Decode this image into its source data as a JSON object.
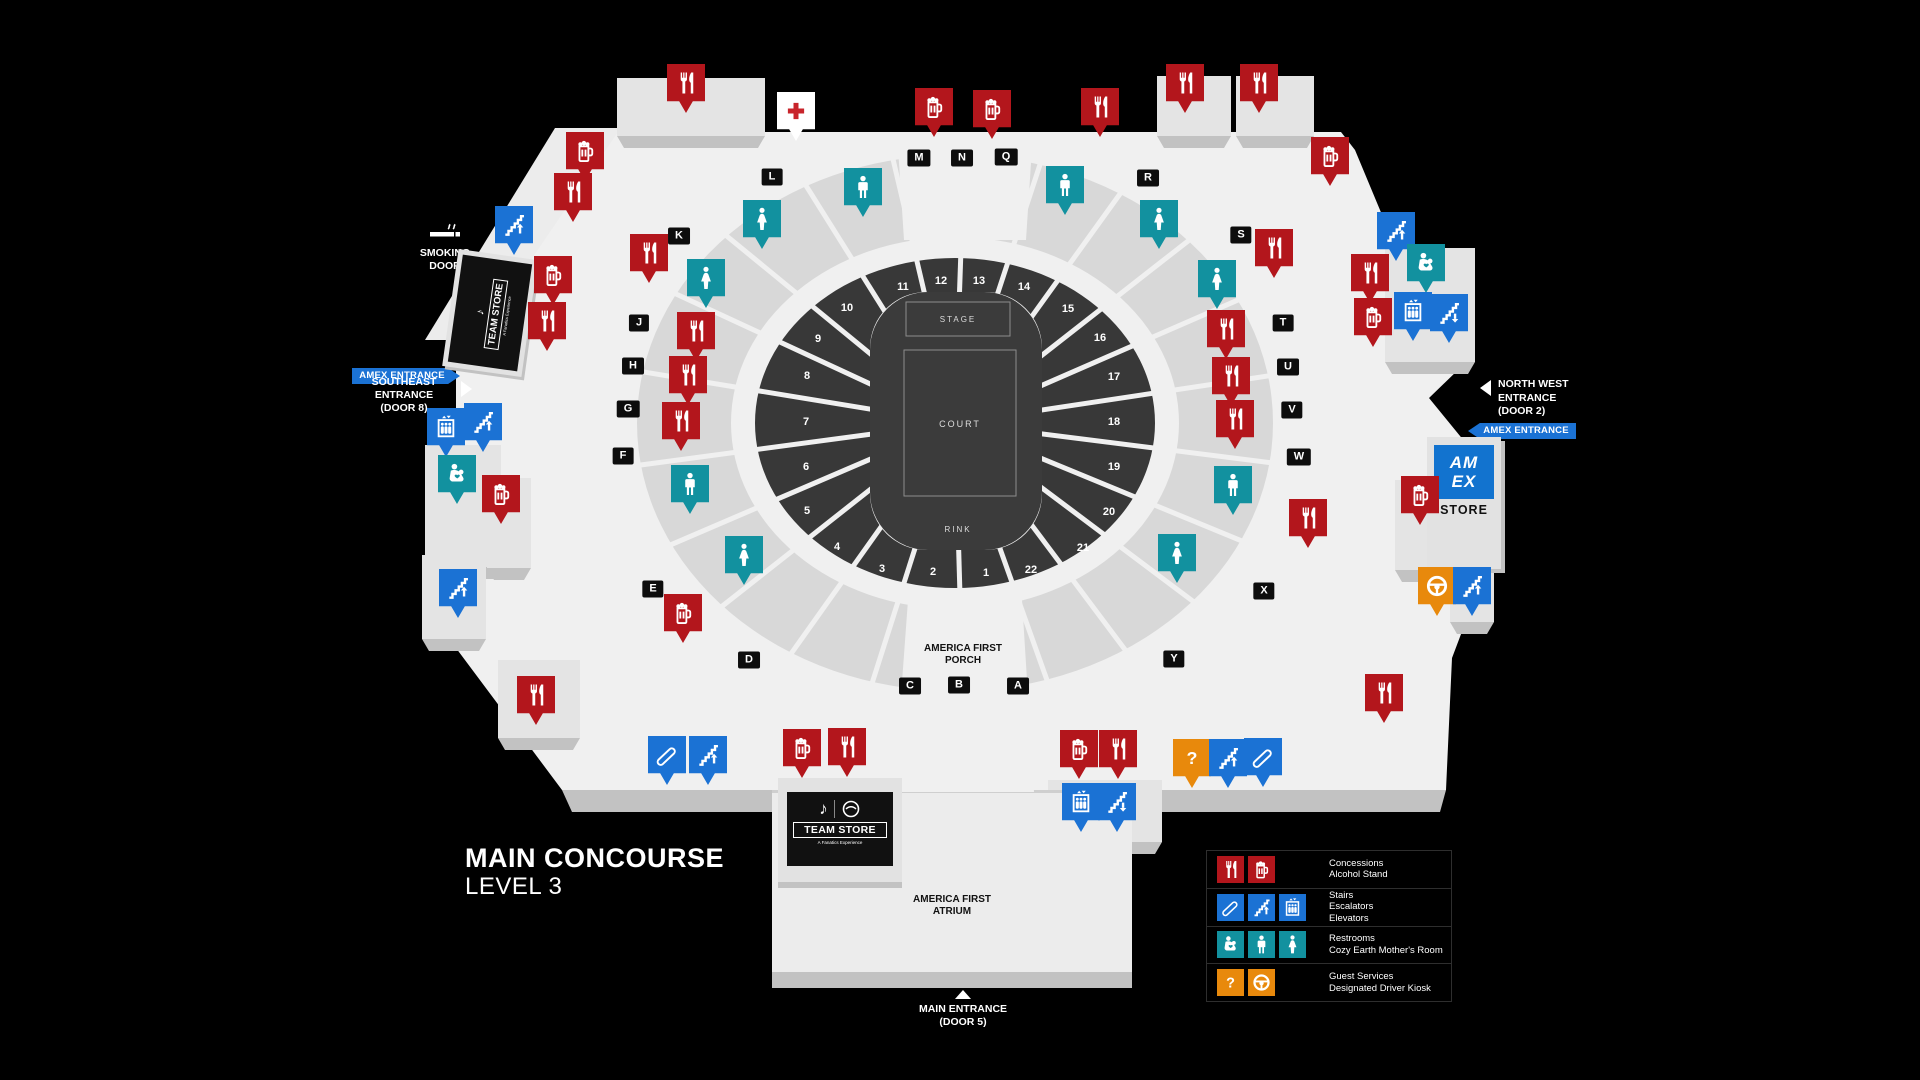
{
  "colors": {
    "red": "#b3161c",
    "blue": "#1b72d4",
    "teal": "#12919f",
    "orange": "#e8890c"
  },
  "title": {
    "line1": "MAIN CONCOURSE",
    "line2": "LEVEL 3"
  },
  "arena": {
    "stage": "STAGE",
    "court": "COURT",
    "rink": "RINK"
  },
  "porch": {
    "line1": "AMERICA FIRST",
    "line2": "PORCH"
  },
  "atrium": {
    "line1": "AMERICA FIRST",
    "line2": "ATRIUM"
  },
  "entrances": {
    "main": {
      "line1": "MAIN ENTRANCE",
      "line2": "(DOOR 5)"
    },
    "southeast": {
      "line1": "SOUTHEAST",
      "line2": "ENTRANCE",
      "line3": "(DOOR 8)"
    },
    "northwest": {
      "line1": "NORTH WEST",
      "line2": "ENTRANCE",
      "line3": "(DOOR 2)"
    },
    "amex_label": "AMEX ENTRANCE",
    "smoking": {
      "line1": "SMOKING",
      "line2": "DOOR"
    }
  },
  "stores": {
    "team_store": {
      "name": "TEAM STORE",
      "sub": "A Fanatics Experience",
      "note_icon": "♪"
    },
    "amex": {
      "logo_line1": "AM",
      "logo_line2": "EX",
      "label": "STORE"
    }
  },
  "legend": {
    "rows": [
      {
        "color": "red",
        "icons": [
          "fork",
          "beer"
        ],
        "lines": [
          "Concessions",
          "Alcohol Stand"
        ]
      },
      {
        "color": "blue",
        "icons": [
          "escalator",
          "stairs-up",
          "elevator"
        ],
        "lines": [
          "Stairs",
          "Escalators",
          "Elevators"
        ]
      },
      {
        "color": "teal",
        "icons": [
          "mother",
          "man",
          "woman"
        ],
        "lines": [
          "Restrooms",
          "Cozy Earth Mother's Room"
        ]
      },
      {
        "color": "orange",
        "icons": [
          "question",
          "driver"
        ],
        "lines": [
          "Guest Services",
          "Designated Driver Kiosk"
        ]
      }
    ]
  },
  "sections": [
    {
      "n": "1",
      "x": 986,
      "y": 572
    },
    {
      "n": "2",
      "x": 933,
      "y": 571
    },
    {
      "n": "3",
      "x": 882,
      "y": 568
    },
    {
      "n": "4",
      "x": 837,
      "y": 546
    },
    {
      "n": "5",
      "x": 807,
      "y": 510
    },
    {
      "n": "6",
      "x": 806,
      "y": 466
    },
    {
      "n": "7",
      "x": 806,
      "y": 421
    },
    {
      "n": "8",
      "x": 807,
      "y": 375
    },
    {
      "n": "9",
      "x": 818,
      "y": 338
    },
    {
      "n": "10",
      "x": 847,
      "y": 307
    },
    {
      "n": "11",
      "x": 903,
      "y": 286
    },
    {
      "n": "12",
      "x": 941,
      "y": 280
    },
    {
      "n": "13",
      "x": 979,
      "y": 280
    },
    {
      "n": "14",
      "x": 1024,
      "y": 286
    },
    {
      "n": "15",
      "x": 1068,
      "y": 308
    },
    {
      "n": "16",
      "x": 1100,
      "y": 337
    },
    {
      "n": "17",
      "x": 1114,
      "y": 376
    },
    {
      "n": "18",
      "x": 1114,
      "y": 421
    },
    {
      "n": "19",
      "x": 1114,
      "y": 466
    },
    {
      "n": "20",
      "x": 1109,
      "y": 511
    },
    {
      "n": "21",
      "x": 1083,
      "y": 547
    },
    {
      "n": "22",
      "x": 1031,
      "y": 569
    }
  ],
  "letters": [
    {
      "l": "A",
      "x": 1018,
      "y": 686
    },
    {
      "l": "B",
      "x": 959,
      "y": 685
    },
    {
      "l": "C",
      "x": 910,
      "y": 686
    },
    {
      "l": "D",
      "x": 749,
      "y": 660
    },
    {
      "l": "E",
      "x": 653,
      "y": 589
    },
    {
      "l": "F",
      "x": 623,
      "y": 456
    },
    {
      "l": "G",
      "x": 628,
      "y": 409
    },
    {
      "l": "H",
      "x": 633,
      "y": 366
    },
    {
      "l": "J",
      "x": 639,
      "y": 323
    },
    {
      "l": "K",
      "x": 679,
      "y": 236
    },
    {
      "l": "L",
      "x": 772,
      "y": 177
    },
    {
      "l": "M",
      "x": 919,
      "y": 158
    },
    {
      "l": "N",
      "x": 962,
      "y": 158
    },
    {
      "l": "Q",
      "x": 1006,
      "y": 157
    },
    {
      "l": "R",
      "x": 1148,
      "y": 178
    },
    {
      "l": "S",
      "x": 1241,
      "y": 235
    },
    {
      "l": "T",
      "x": 1283,
      "y": 323
    },
    {
      "l": "U",
      "x": 1288,
      "y": 367
    },
    {
      "l": "V",
      "x": 1292,
      "y": 410
    },
    {
      "l": "W",
      "x": 1299,
      "y": 457
    },
    {
      "l": "X",
      "x": 1264,
      "y": 591
    },
    {
      "l": "Y",
      "x": 1174,
      "y": 659
    }
  ],
  "pins": [
    {
      "t": "fork",
      "x": 686,
      "y": 88
    },
    {
      "t": "firstaid",
      "x": 796,
      "y": 116
    },
    {
      "t": "beer",
      "x": 934,
      "y": 112
    },
    {
      "t": "beer",
      "x": 992,
      "y": 114
    },
    {
      "t": "fork",
      "x": 1100,
      "y": 112
    },
    {
      "t": "fork",
      "x": 1185,
      "y": 88
    },
    {
      "t": "fork",
      "x": 1259,
      "y": 88
    },
    {
      "t": "beer",
      "x": 1330,
      "y": 161
    },
    {
      "t": "beer",
      "x": 585,
      "y": 156
    },
    {
      "t": "fork",
      "x": 573,
      "y": 197
    },
    {
      "t": "stairs-up",
      "x": 514,
      "y": 230
    },
    {
      "t": "beer",
      "x": 553,
      "y": 280
    },
    {
      "t": "fork",
      "x": 547,
      "y": 326
    },
    {
      "t": "fork",
      "x": 649,
      "y": 258
    },
    {
      "t": "fork",
      "x": 696,
      "y": 336
    },
    {
      "t": "fork",
      "x": 688,
      "y": 380
    },
    {
      "t": "fork",
      "x": 681,
      "y": 426
    },
    {
      "t": "man",
      "x": 690,
      "y": 489
    },
    {
      "t": "woman",
      "x": 744,
      "y": 560
    },
    {
      "t": "beer",
      "x": 683,
      "y": 618
    },
    {
      "t": "man",
      "x": 863,
      "y": 192
    },
    {
      "t": "woman",
      "x": 762,
      "y": 224
    },
    {
      "t": "woman",
      "x": 706,
      "y": 283
    },
    {
      "t": "man",
      "x": 1065,
      "y": 190
    },
    {
      "t": "woman",
      "x": 1159,
      "y": 224
    },
    {
      "t": "woman",
      "x": 1217,
      "y": 284
    },
    {
      "t": "fork",
      "x": 1274,
      "y": 253
    },
    {
      "t": "fork",
      "x": 1226,
      "y": 334
    },
    {
      "t": "fork",
      "x": 1231,
      "y": 381
    },
    {
      "t": "fork",
      "x": 1235,
      "y": 424
    },
    {
      "t": "man",
      "x": 1233,
      "y": 490
    },
    {
      "t": "woman",
      "x": 1177,
      "y": 558
    },
    {
      "t": "fork",
      "x": 1308,
      "y": 523
    },
    {
      "t": "fork",
      "x": 1370,
      "y": 278
    },
    {
      "t": "beer",
      "x": 1373,
      "y": 322
    },
    {
      "t": "stairs-up",
      "x": 1396,
      "y": 236
    },
    {
      "t": "mother",
      "x": 1426,
      "y": 268
    },
    {
      "t": "elevator",
      "x": 1413,
      "y": 316
    },
    {
      "t": "stairs-down",
      "x": 1449,
      "y": 318
    },
    {
      "t": "beer",
      "x": 1420,
      "y": 500
    },
    {
      "t": "driver",
      "x": 1437,
      "y": 591
    },
    {
      "t": "stairs-up",
      "x": 1472,
      "y": 591
    },
    {
      "t": "elevator",
      "x": 446,
      "y": 432
    },
    {
      "t": "stairs-up",
      "x": 483,
      "y": 427
    },
    {
      "t": "mother",
      "x": 457,
      "y": 479
    },
    {
      "t": "beer",
      "x": 501,
      "y": 499
    },
    {
      "t": "stairs-up",
      "x": 458,
      "y": 593
    },
    {
      "t": "fork",
      "x": 536,
      "y": 700
    },
    {
      "t": "escalator",
      "x": 667,
      "y": 760
    },
    {
      "t": "stairs-up",
      "x": 708,
      "y": 760
    },
    {
      "t": "beer",
      "x": 802,
      "y": 753
    },
    {
      "t": "fork",
      "x": 847,
      "y": 752
    },
    {
      "t": "beer",
      "x": 1079,
      "y": 754
    },
    {
      "t": "fork",
      "x": 1118,
      "y": 754
    },
    {
      "t": "question",
      "x": 1192,
      "y": 763
    },
    {
      "t": "stairs-up",
      "x": 1228,
      "y": 763
    },
    {
      "t": "escalator",
      "x": 1263,
      "y": 762
    },
    {
      "t": "elevator",
      "x": 1081,
      "y": 807
    },
    {
      "t": "stairs-down",
      "x": 1117,
      "y": 807
    },
    {
      "t": "fork",
      "x": 1384,
      "y": 698
    }
  ]
}
